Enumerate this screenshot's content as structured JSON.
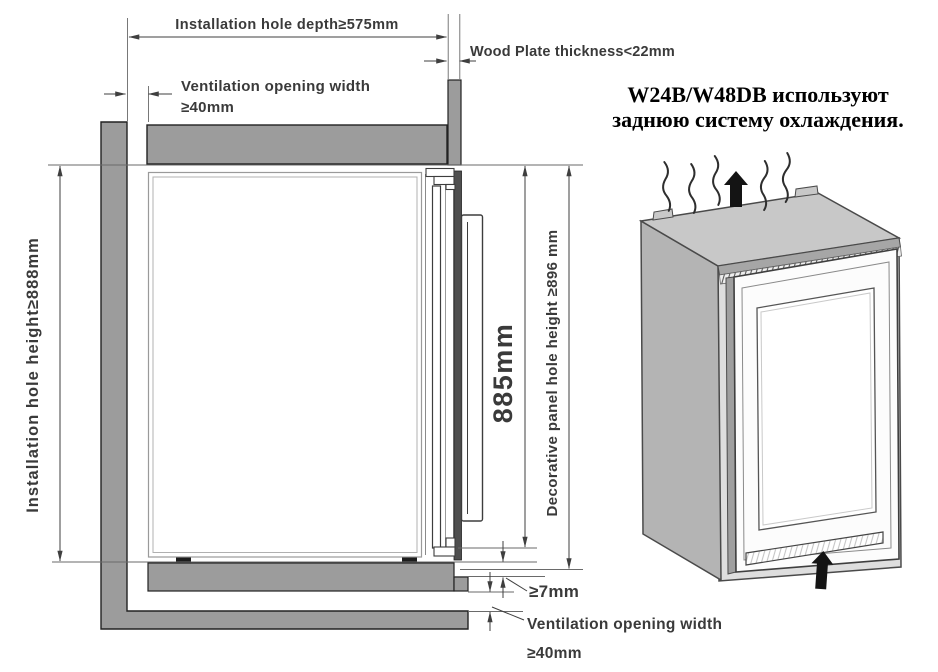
{
  "note": {
    "line1": "W24B/W48DB используют",
    "line2": "заднюю систему охлаждения."
  },
  "labels": {
    "install_depth": "Installation hole depth≥575mm",
    "wood_plate_thickness": "Wood Plate thickness<22mm",
    "vent_top_1": "Ventilation opening width",
    "vent_top_2": "≥40mm",
    "install_height": "Installation hole height≥888mm",
    "door_height": "885mm",
    "decor_panel_height": "Decorative panel hole height ≥896 mm",
    "bottom_clearance": "≥7mm",
    "vent_bottom_1": "Ventilation opening width",
    "vent_bottom_2": "≥40mm"
  },
  "icons": {
    "heat_waves": "heat-waves-icon",
    "airflow_out_top": "up-arrow-icon",
    "airflow_in_bottom": "up-arrow-icon"
  },
  "colors": {
    "panel_gray": "#9c9c9c",
    "line_dark": "#3f3f3f",
    "arrow_black": "#141414"
  }
}
